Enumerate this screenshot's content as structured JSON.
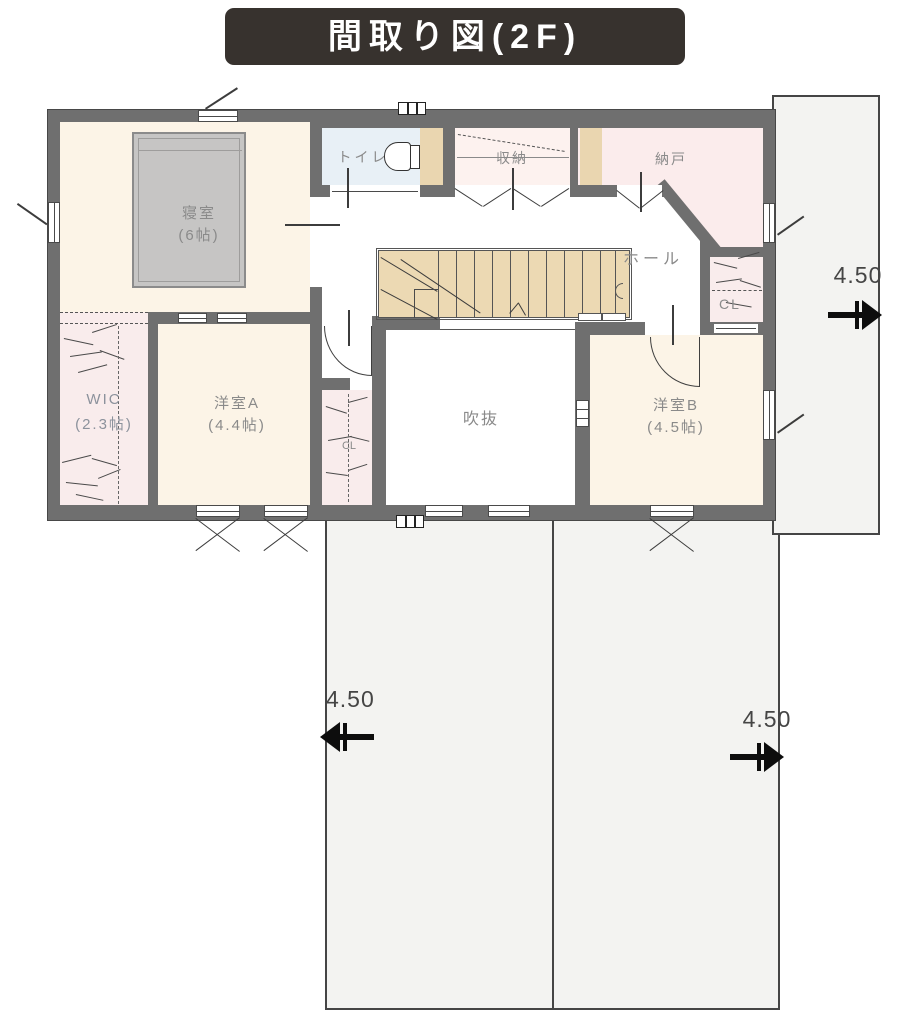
{
  "title": "間取り図(2F)",
  "rooms": {
    "bedroom": {
      "name": "寝室",
      "size": "(6帖)"
    },
    "toilet": {
      "name": "トイレ"
    },
    "storage": {
      "name": "収納"
    },
    "nando": {
      "name": "納戸"
    },
    "hall": {
      "name": "ホール"
    },
    "cl_upper": {
      "name": "CL"
    },
    "wic": {
      "name": "WIC",
      "size": "(2.3帖)"
    },
    "room_a": {
      "name": "洋室A",
      "size": "(4.4帖)"
    },
    "void": {
      "name": "吹抜"
    },
    "cl_room_a": {
      "name": "CL"
    },
    "room_b": {
      "name": "洋室B",
      "size": "(4.5帖)"
    }
  },
  "dimensions": {
    "right": "4.50",
    "bottom_left": "4.50",
    "bottom_right": "4.50"
  },
  "colors": {
    "wall": "#6f6f6f",
    "title_bg": "#37322e",
    "floor_cream": "#fcf4e7",
    "floor_pink": "#f9ecec",
    "floor_blue": "#e8f0f6",
    "stairs_tan": "#ecd9b3",
    "roof_fill": "#f3f3f1",
    "label_gray": "#8a8a8a"
  }
}
